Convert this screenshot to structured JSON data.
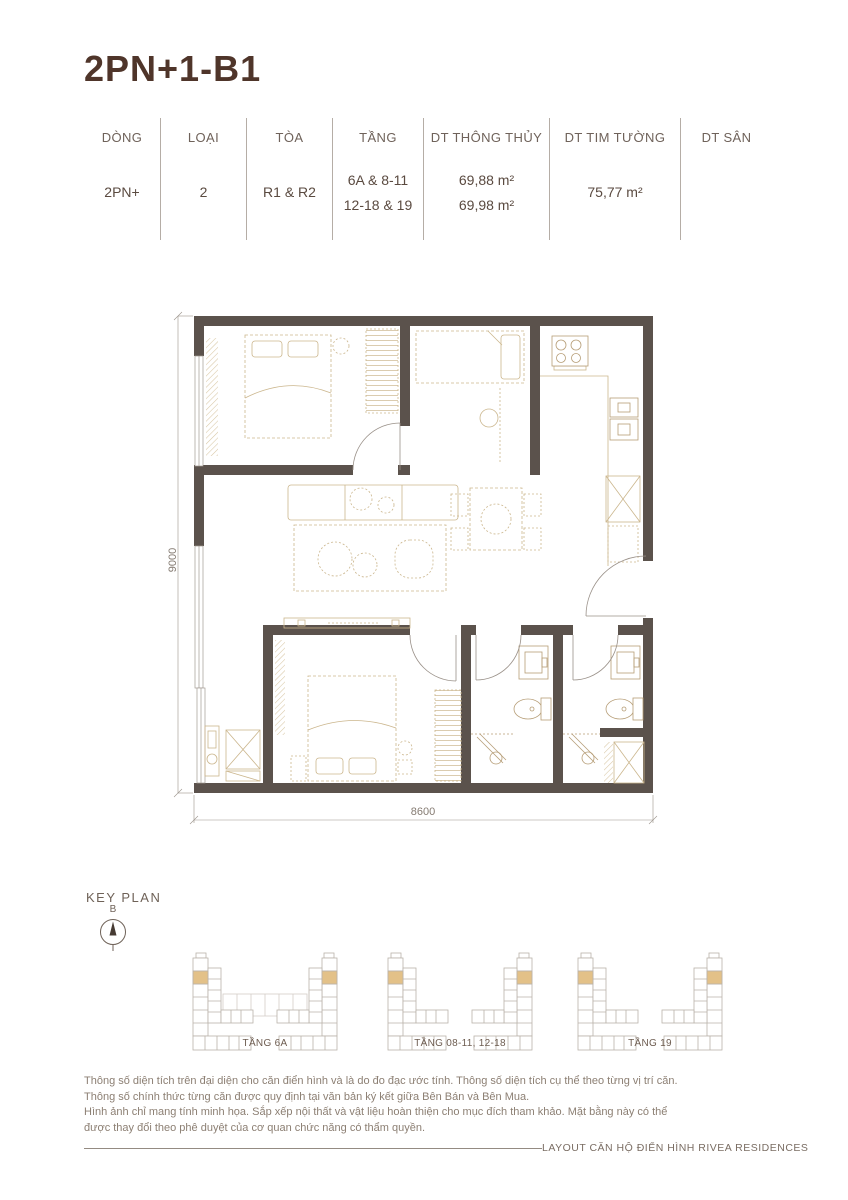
{
  "page": {
    "title": "2PN+1-B1"
  },
  "spec_table": {
    "columns": [
      {
        "header": "DÒNG",
        "values": [
          "2PN+"
        ]
      },
      {
        "header": "LOẠI",
        "values": [
          "2"
        ]
      },
      {
        "header": "TÒA",
        "values": [
          "R1 & R2"
        ]
      },
      {
        "header": "TẦNG",
        "values": [
          "6A & 8-11",
          "12-18 & 19"
        ]
      },
      {
        "header": "DT THÔNG THỦY",
        "values": [
          "69,88 m²",
          "69,98 m²"
        ]
      },
      {
        "header": "DT TIM TƯỜNG",
        "values": [
          "75,77 m²"
        ]
      },
      {
        "header": "DT SÂN",
        "values": []
      }
    ]
  },
  "floor_plan": {
    "dimension_height": "9000",
    "dimension_width": "8600",
    "wall_color": "#5b524c",
    "furniture_color": "#cbb68d"
  },
  "key_plan": {
    "title": "KEY PLAN",
    "compass_label": "B",
    "highlight_color": "#e3c188",
    "variants": [
      {
        "label": "TẦNG 6A"
      },
      {
        "label": "TẦNG 08-11, 12-18"
      },
      {
        "label": "TẦNG 19"
      }
    ]
  },
  "footer": {
    "disclaimer_lines": [
      "Thông số diện tích trên đại diện cho căn điển hình và là do đo đạc ước tính. Thông số diện tích cụ thể theo từng vị trí căn.",
      "Thông số chính thức từng căn được quy định tại văn bản ký kết giữa Bên Bán và Bên Mua.",
      "Hình ảnh chỉ mang tính minh họa. Sắp xếp nội thất và vật liệu hoàn thiện cho mục đích tham khảo. Mặt bằng này có thể",
      "được thay đổi theo phê duyệt của cơ quan chức năng có thẩm quyền."
    ],
    "caption": "LAYOUT CĂN HỘ ĐIỂN HÌNH RIVEA RESIDENCES"
  }
}
